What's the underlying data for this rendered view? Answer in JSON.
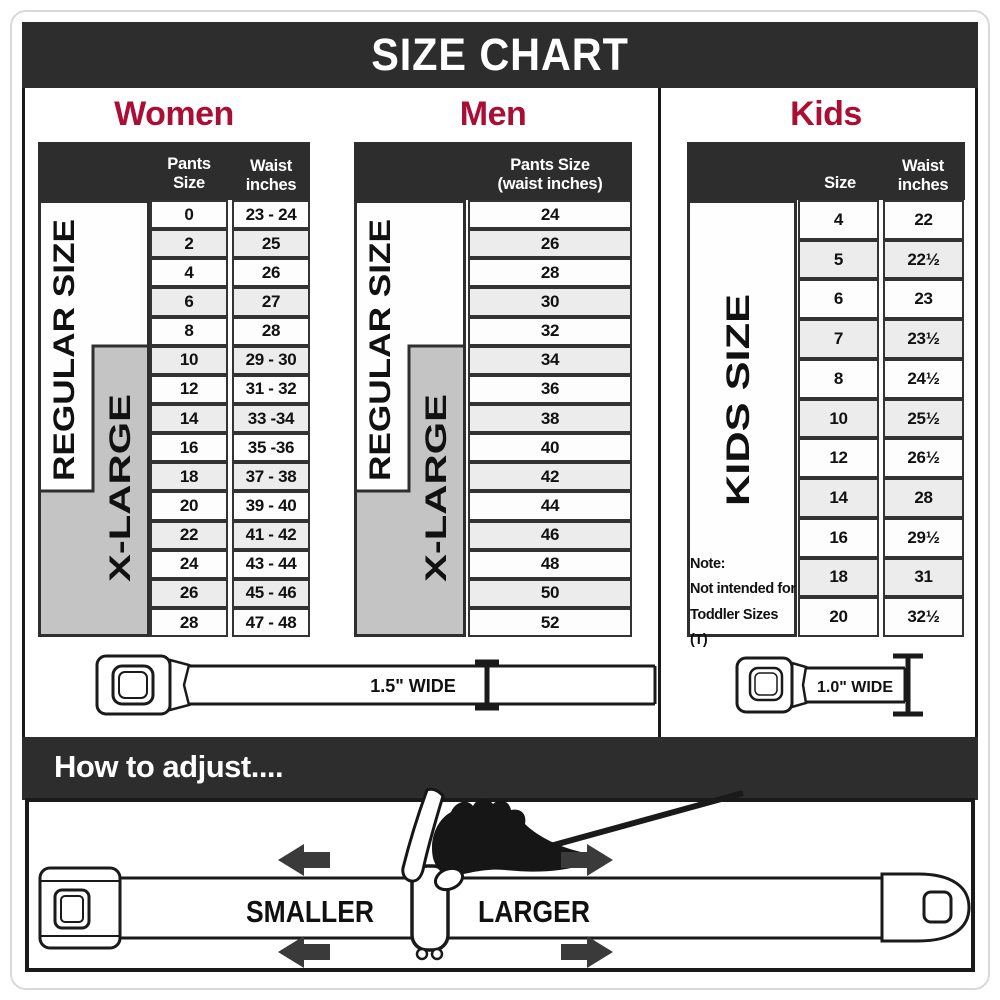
{
  "title": "SIZE CHART",
  "palette": {
    "accent": "#ab0e34",
    "band_bg": "#2d2d2d",
    "border_dark": "#1a1a1a",
    "cell_border": "#333333",
    "xlarge_gray": "#c4c4c4",
    "row_stripe": "#ececec"
  },
  "women": {
    "heading": "Women",
    "col_size_header": "Pants Size",
    "col_waist_header_line1": "Waist",
    "col_waist_header_line2": "inches",
    "regular_label": "REGULAR SIZE",
    "xlarge_label": "X-LARGE",
    "rows": [
      {
        "size": "0",
        "waist": "23 - 24"
      },
      {
        "size": "2",
        "waist": "25"
      },
      {
        "size": "4",
        "waist": "26"
      },
      {
        "size": "6",
        "waist": "27"
      },
      {
        "size": "8",
        "waist": "28"
      },
      {
        "size": "10",
        "waist": "29 - 30"
      },
      {
        "size": "12",
        "waist": "31 - 32"
      },
      {
        "size": "14",
        "waist": "33 -34"
      },
      {
        "size": "16",
        "waist": "35 -36"
      },
      {
        "size": "18",
        "waist": "37 - 38"
      },
      {
        "size": "20",
        "waist": "39 - 40"
      },
      {
        "size": "22",
        "waist": "41 - 42"
      },
      {
        "size": "24",
        "waist": "43 - 44"
      },
      {
        "size": "26",
        "waist": "45 - 46"
      },
      {
        "size": "28",
        "waist": "47 - 48"
      }
    ],
    "belt_width_label": "1.5\" WIDE"
  },
  "men": {
    "heading": "Men",
    "col_header_line1": "Pants Size",
    "col_header_line2": "(waist inches)",
    "regular_label": "REGULAR SIZE",
    "xlarge_label": "X-LARGE",
    "rows": [
      "24",
      "26",
      "28",
      "30",
      "32",
      "34",
      "36",
      "38",
      "40",
      "42",
      "44",
      "46",
      "48",
      "50",
      "52"
    ]
  },
  "kids": {
    "heading": "Kids",
    "col_size_header": "Size",
    "col_waist_header_line1": "Waist",
    "col_waist_header_line2": "inches",
    "side_label": "KIDS SIZE",
    "note_line1": "Note:",
    "note_line2": "Not intended for",
    "note_line3": "Toddler Sizes (T)",
    "rows": [
      {
        "size": "4",
        "waist": "22"
      },
      {
        "size": "5",
        "waist": "22½"
      },
      {
        "size": "6",
        "waist": "23"
      },
      {
        "size": "7",
        "waist": "23½"
      },
      {
        "size": "8",
        "waist": "24½"
      },
      {
        "size": "10",
        "waist": "25½"
      },
      {
        "size": "12",
        "waist": "26½"
      },
      {
        "size": "14",
        "waist": "28"
      },
      {
        "size": "16",
        "waist": "29½"
      },
      {
        "size": "18",
        "waist": "31"
      },
      {
        "size": "20",
        "waist": "32½"
      }
    ],
    "belt_width_label": "1.0\" WIDE"
  },
  "adjust": {
    "heading": "How to adjust....",
    "smaller_label": "SMALLER",
    "larger_label": "LARGER"
  }
}
